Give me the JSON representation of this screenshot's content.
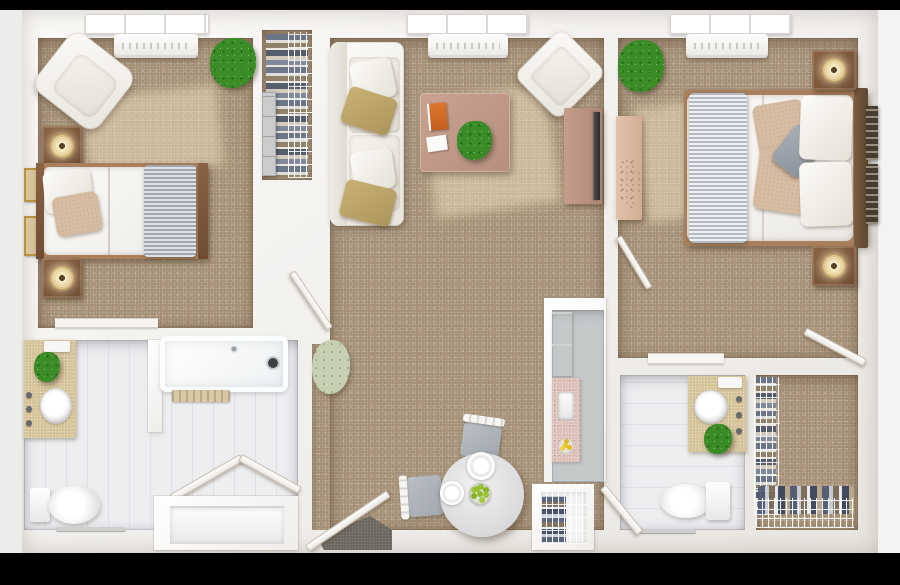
{
  "scene": {
    "kind": "3d-rendered-floor-plan-top-view",
    "unit": "two-bedroom two-bath apartment"
  },
  "palette": {
    "margin": "#ececeb",
    "carpet": "#a8947a",
    "tile": "#edeef0",
    "kitchen_floor": "#c6c9ca",
    "wood_dark": "#8a6244",
    "wood_light": "#e3c3ac",
    "khaki": "#c9b274",
    "counter_tan": "#d8c69c",
    "granite": "#dcc2ba",
    "plant_green": "#3a8c27",
    "plant_pale": "#c7cfb2",
    "mat_dark": "#6e6a62",
    "blanket_gray": "#b7bdc6",
    "coffee_table": "#c9a292",
    "tv_console": "#c49d8b",
    "book_orange": "#e0762f",
    "apple_green": "#8fba2e",
    "lemon_yellow": "#e8c62e",
    "tv_black": "#2b2b2b"
  },
  "rooms": [
    {
      "name": "bedroom-1",
      "floor": "carpet",
      "items": [
        "window",
        "ptac-heat-pump",
        "lounge-chair",
        "potted-plant",
        "nightstand-with-lamp",
        "twin-bed",
        "gray-throw-blanket",
        "nightstand-with-lamp",
        "framed-wall-art",
        "framed-wall-art",
        "entry-door",
        "closet-track"
      ]
    },
    {
      "name": "bedroom-1-closet",
      "floor": "carpet",
      "items": [
        "wire-shelving",
        "hanging-clothes",
        "storage-tower"
      ]
    },
    {
      "name": "living-dining-room",
      "floor": "carpet",
      "items": [
        "window",
        "ptac-heat-pump",
        "loveseat-sofa",
        "throw-pillows",
        "accent-chair",
        "coffee-table",
        "book",
        "notepad",
        "potted-plant",
        "tv-stand",
        "television",
        "floor-plant",
        "round-dining-table",
        "dinner-plate",
        "dinner-plate",
        "fruit-bowl",
        "dining-chair",
        "dining-chair",
        "entry-door",
        "door-mat"
      ]
    },
    {
      "name": "bedroom-2",
      "floor": "carpet",
      "items": [
        "window",
        "ptac-heat-pump",
        "potted-plant",
        "dresser",
        "queen-bed",
        "striped-throw-blanket",
        "pillows",
        "nightstand-with-lamp",
        "nightstand-with-lamp",
        "framed-wall-art",
        "room-door",
        "closet-door",
        "doorway-threshold"
      ]
    },
    {
      "name": "bathroom-1",
      "floor": "tile",
      "items": [
        "vanity-with-sink",
        "potted-plant",
        "faucet-handles",
        "bathtub-shower",
        "bath-mat",
        "bifold-doors",
        "toilet",
        "towel-bar"
      ]
    },
    {
      "name": "kitchen",
      "floor": "vinyl",
      "items": [
        "upper-cabinets",
        "granite-countertop",
        "sink",
        "lemon-bowl"
      ]
    },
    {
      "name": "bathroom-2",
      "floor": "tile",
      "items": [
        "vanity-with-round-sink",
        "potted-plant",
        "faucet-handles",
        "toilet",
        "towel-bar",
        "room-door"
      ]
    },
    {
      "name": "walk-in-closet",
      "floor": "carpet",
      "items": [
        "wire-shelving",
        "hanging-clothes",
        "folded-clothes"
      ]
    },
    {
      "name": "entry-closet",
      "floor": "none",
      "items": [
        "wire-shelving",
        "folded-clothes"
      ]
    },
    {
      "name": "linen-cabinet",
      "floor": "none",
      "items": [
        "built-in-shelf"
      ]
    }
  ]
}
